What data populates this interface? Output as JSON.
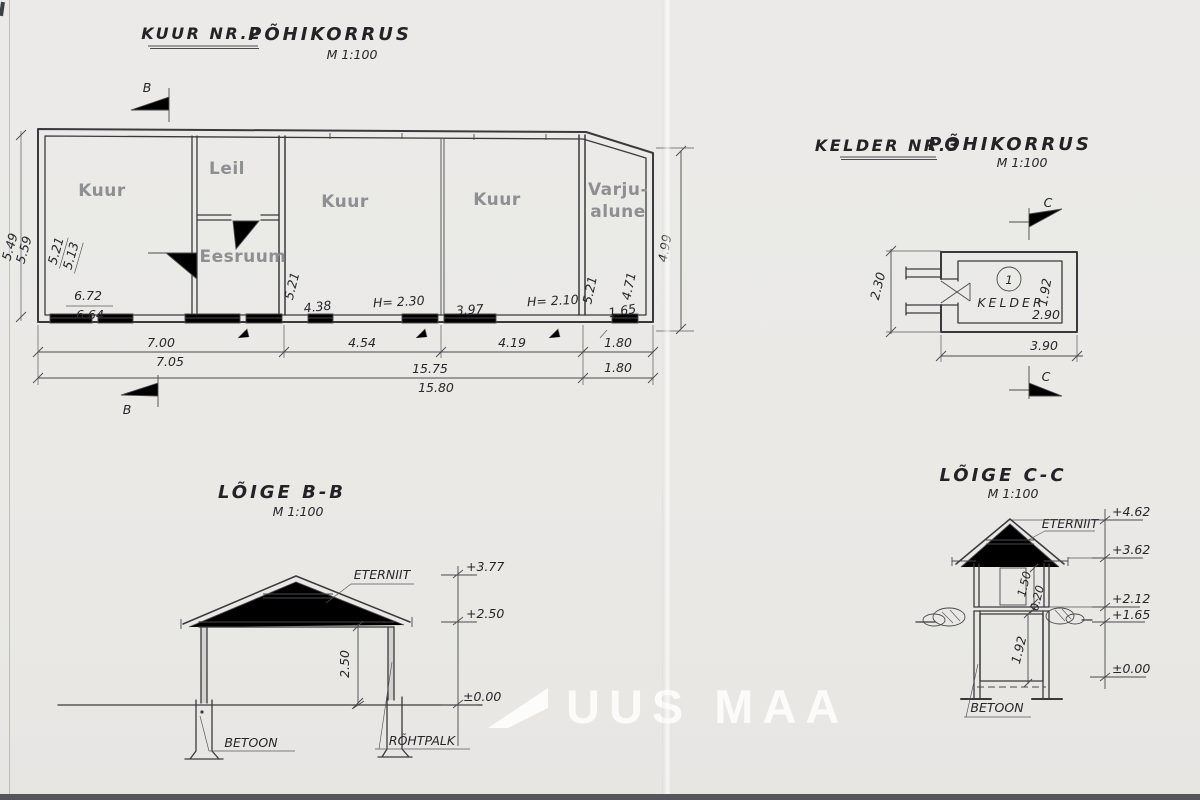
{
  "watermark": {
    "text": "UUS MAA"
  },
  "main_plan": {
    "title": "KUUR NR.2",
    "subtitle": "PÕHIKORRUS",
    "scale": "M 1:100",
    "marker_top": "B",
    "marker_bottom": "B",
    "rooms": {
      "kuur1": "Kuur",
      "leil": "Leil",
      "eesruum": "Eesruum",
      "kuur2": "Kuur",
      "kuur3": "Kuur",
      "varjualune_line1": "Varju-",
      "varjualune_line2": "alune"
    },
    "dims": {
      "left_outer_a": "5.49",
      "left_outer_b": "5.59",
      "kuur1_height_a": "5.21",
      "kuur1_height_b": "5.13",
      "kuur1_width_a": "6.72",
      "kuur1_width_b": "6.64",
      "kuur2_left": "5.21",
      "kuur2_opening": "4.38",
      "kuur2_ceiling": "H= 2.30",
      "kuur3_opening": "3.97",
      "kuur3_ceiling": "H= 2.10",
      "kuur3_right": "5.21",
      "varjualune_height": "4.71",
      "varjualune_width": "1.65",
      "right_outer": "4.99",
      "bottom_seg1": "7.00",
      "bottom_seg1_alt": "7.05",
      "bottom_seg2": "4.54",
      "bottom_seg3": "4.19",
      "bottom_seg4": "1.80",
      "bottom_total": "15.75",
      "bottom_total_alt": "15.80",
      "bottom_seg4_alt": "1.80"
    }
  },
  "kelder_plan": {
    "title": "KELDER NR.3",
    "subtitle": "PÕHIKORRUS",
    "scale": "M 1:100",
    "marker_top": "C",
    "marker_bottom": "C",
    "room_label": "KELDER",
    "room_number": "1",
    "dims": {
      "outer_height": "2.30",
      "inner_height": "1.92",
      "inner_width": "2.90",
      "outer_width": "3.90"
    }
  },
  "section_bb": {
    "title": "LÕIGE B-B",
    "scale": "M 1:100",
    "roof_material": "ETERNIIT",
    "foundation_material": "BETOON",
    "post_material": "RÕHTPALK",
    "elevations": {
      "ridge": "+3.77",
      "eave": "+2.50",
      "ground": "±0.00"
    },
    "dims": {
      "clear_height": "2.50"
    }
  },
  "section_cc": {
    "title": "LÕIGE C-C",
    "scale": "M 1:100",
    "roof_material": "ETERNIIT",
    "foundation_material": "BETOON",
    "elevations": {
      "ridge": "+4.62",
      "eave": "+3.62",
      "floor": "+2.12",
      "ground": "+1.65",
      "cellar": "±0.00"
    },
    "dims": {
      "wall_height": "1.50",
      "floor_thickness": "0.20",
      "cellar_height": "1.92"
    }
  }
}
